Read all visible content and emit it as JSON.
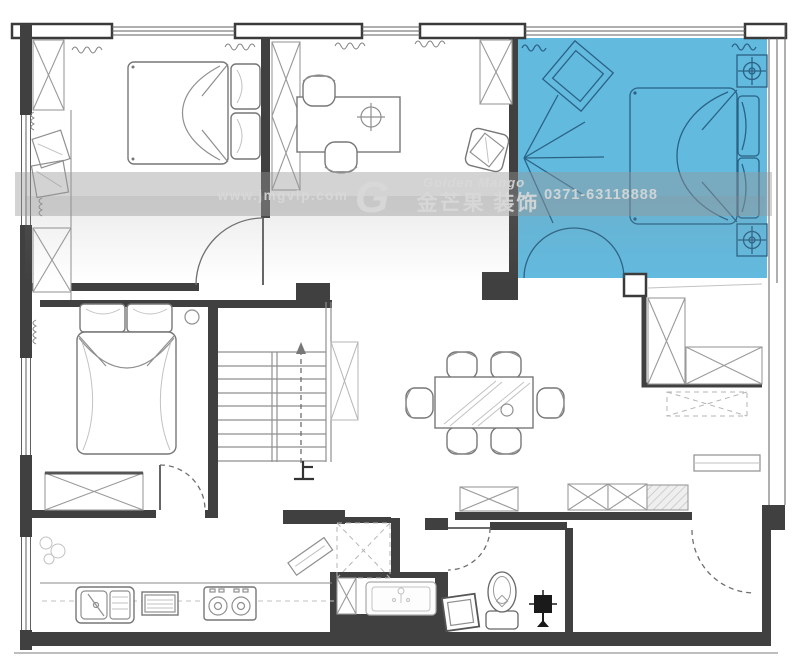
{
  "watermark": {
    "website": "www.jmgvip.com",
    "logo_letter": "G",
    "brand_en": "Golden Mango",
    "brand_cn": "金芒果 装饰",
    "phone": "0371-63118888"
  },
  "stairs": {
    "direction_label": "上"
  },
  "colors": {
    "highlight_room": "#62badf",
    "highlight_stroke": "#2a6285",
    "wall": "#404040",
    "furniture_line": "#8f8f8f",
    "watermark_band": "#969696",
    "watermark_text": "#d9d9d9"
  },
  "icons": [
    "bed-icon",
    "pillow-icon",
    "wardrobe-x-icon",
    "desk-icon",
    "chair-icon",
    "lamp-cross-icon",
    "armchair-icon",
    "dining-table-icon",
    "dining-chair-icon",
    "stairs-up-icon",
    "fridge-icon",
    "kitchen-sink-icon",
    "gas-stove-icon",
    "wash-basin-icon",
    "toilet-icon",
    "washing-machine-icon",
    "floor-stand-icon",
    "door-swing-icon",
    "window-icon",
    "curtain-icon",
    "mirror-diamond-icon",
    "wall-lamp-rays-icon",
    "cushion-icon"
  ]
}
